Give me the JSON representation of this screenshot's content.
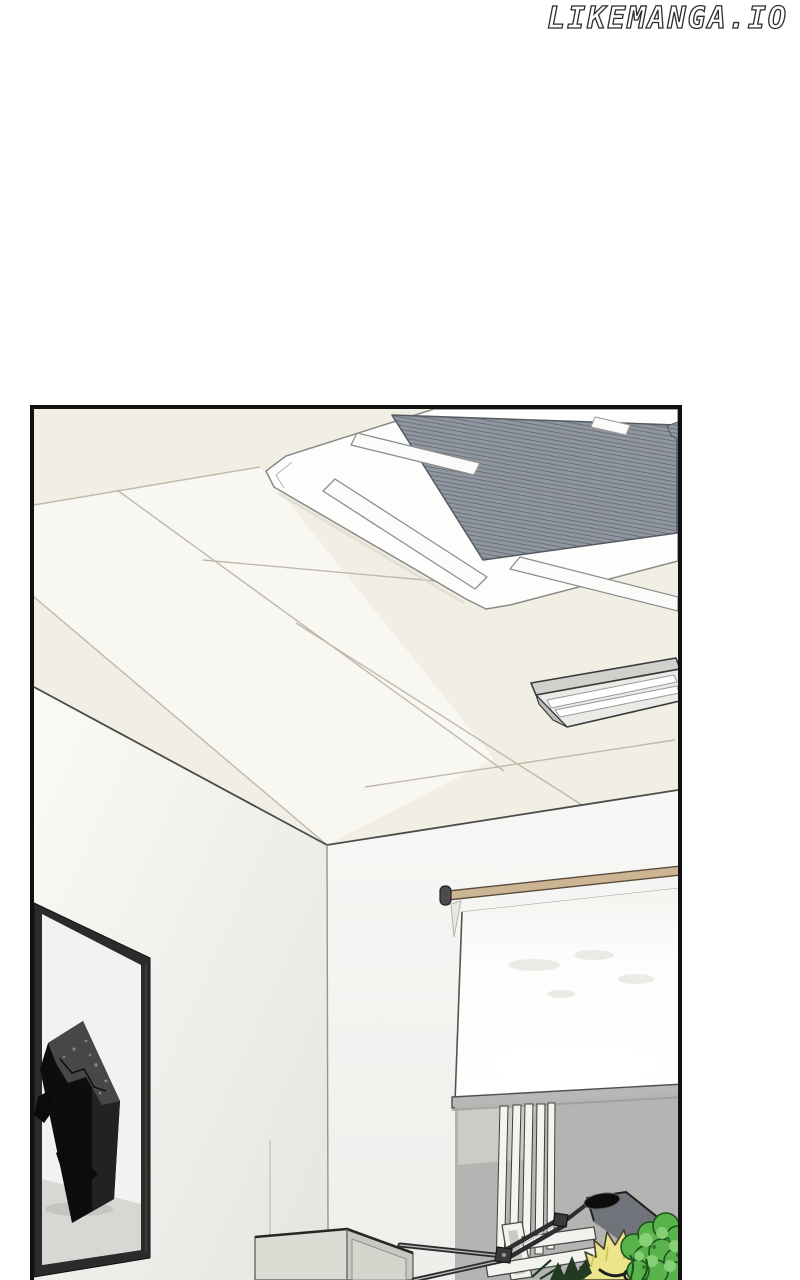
{
  "watermark": {
    "text": "LIKEMANGA.IO"
  },
  "page": {
    "width": 800,
    "height": 1280
  },
  "panel": {
    "x": 30,
    "y": 405,
    "width": 652,
    "height": 875,
    "scene_objects": [
      {
        "name": "ceiling-cassette-ac-unit"
      },
      {
        "name": "ceiling-tiles"
      },
      {
        "name": "fluorescent-light-fixture"
      },
      {
        "name": "projector-screen-rolled-down"
      },
      {
        "name": "wall-picture-frame-black-monolith-art"
      },
      {
        "name": "wall-corner"
      },
      {
        "name": "side-cabinet-open-box"
      },
      {
        "name": "articulated-desk-lamp"
      },
      {
        "name": "blonde-haired-character"
      },
      {
        "name": "green-leafy-plant"
      }
    ]
  },
  "colors": {
    "page_bg": "#ffffff",
    "watermark_outline": "#2e2e2e",
    "panel_border": "#111111",
    "ceiling": "#f1eee3",
    "ceiling_line": "#bdb9ab",
    "ac_grille": "#8e939c",
    "fixture_gray": "#cfd1cc",
    "screen_rod_tan": "#cdb493",
    "screen_white": "#fcfcfb",
    "lower_wall_gray": "#b4b4b2",
    "frame_black": "#2b2b2b",
    "monolith_black": "#0d0d0d",
    "cabinet_gray": "#dbddd5",
    "lamp_shade": "#70747a",
    "hair_yellow": "#ebe48a",
    "plant_green": "#58b44a",
    "plant_light": "#86cf74"
  }
}
